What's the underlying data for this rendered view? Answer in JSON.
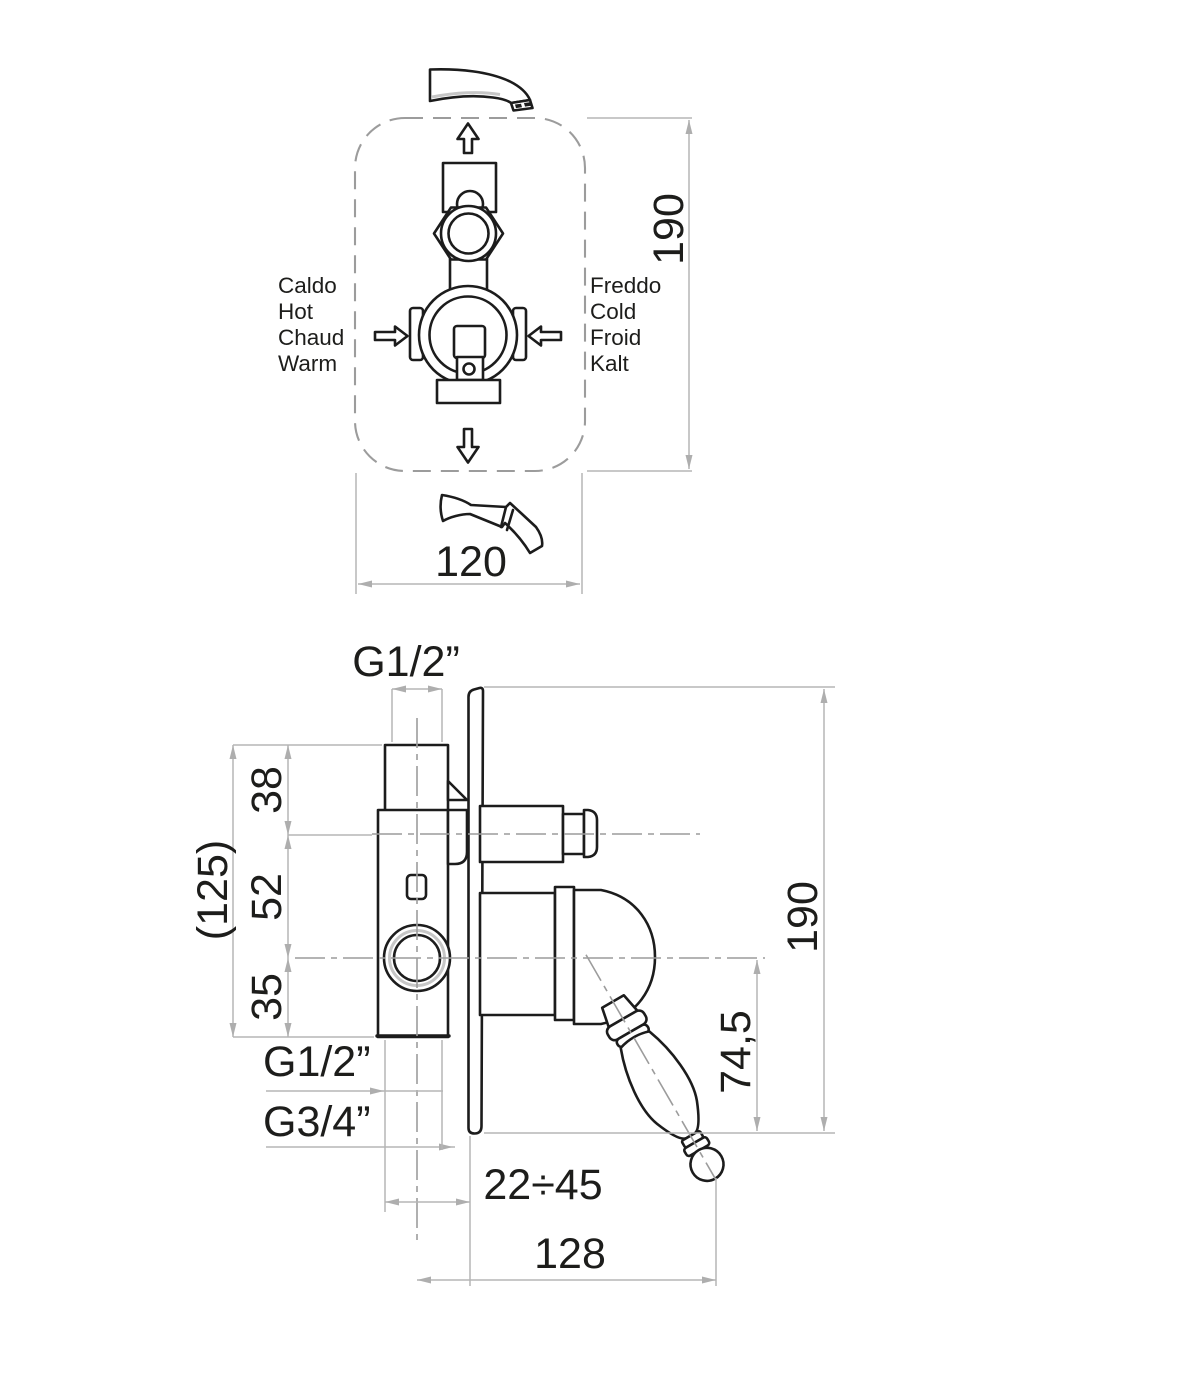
{
  "colors": {
    "line": "#1c1c1c",
    "dimension_lines": "#b5b5b5",
    "centerlines": "#9c9c9c",
    "background": "#ffffff"
  },
  "top_view": {
    "dim_height": "190",
    "dim_width": "120",
    "hot_labels": [
      "Caldo",
      "Hot",
      "Chaud",
      "Warm"
    ],
    "cold_labels": [
      "Freddo",
      "Cold",
      "Froid",
      "Kalt"
    ]
  },
  "side_view": {
    "dim_top_thread": "G1/2”",
    "dim_offset_top": "38",
    "dim_offset_mid": "52",
    "dim_offset_bottom": "35",
    "dim_total_offset": "(125)",
    "dim_bottom_thread": "G1/2”",
    "dim_side_thread": "G3/4”",
    "dim_wall_depth_range": "22÷45",
    "dim_width": "128",
    "dim_height": "190",
    "dim_handle_drop": "74,5"
  }
}
